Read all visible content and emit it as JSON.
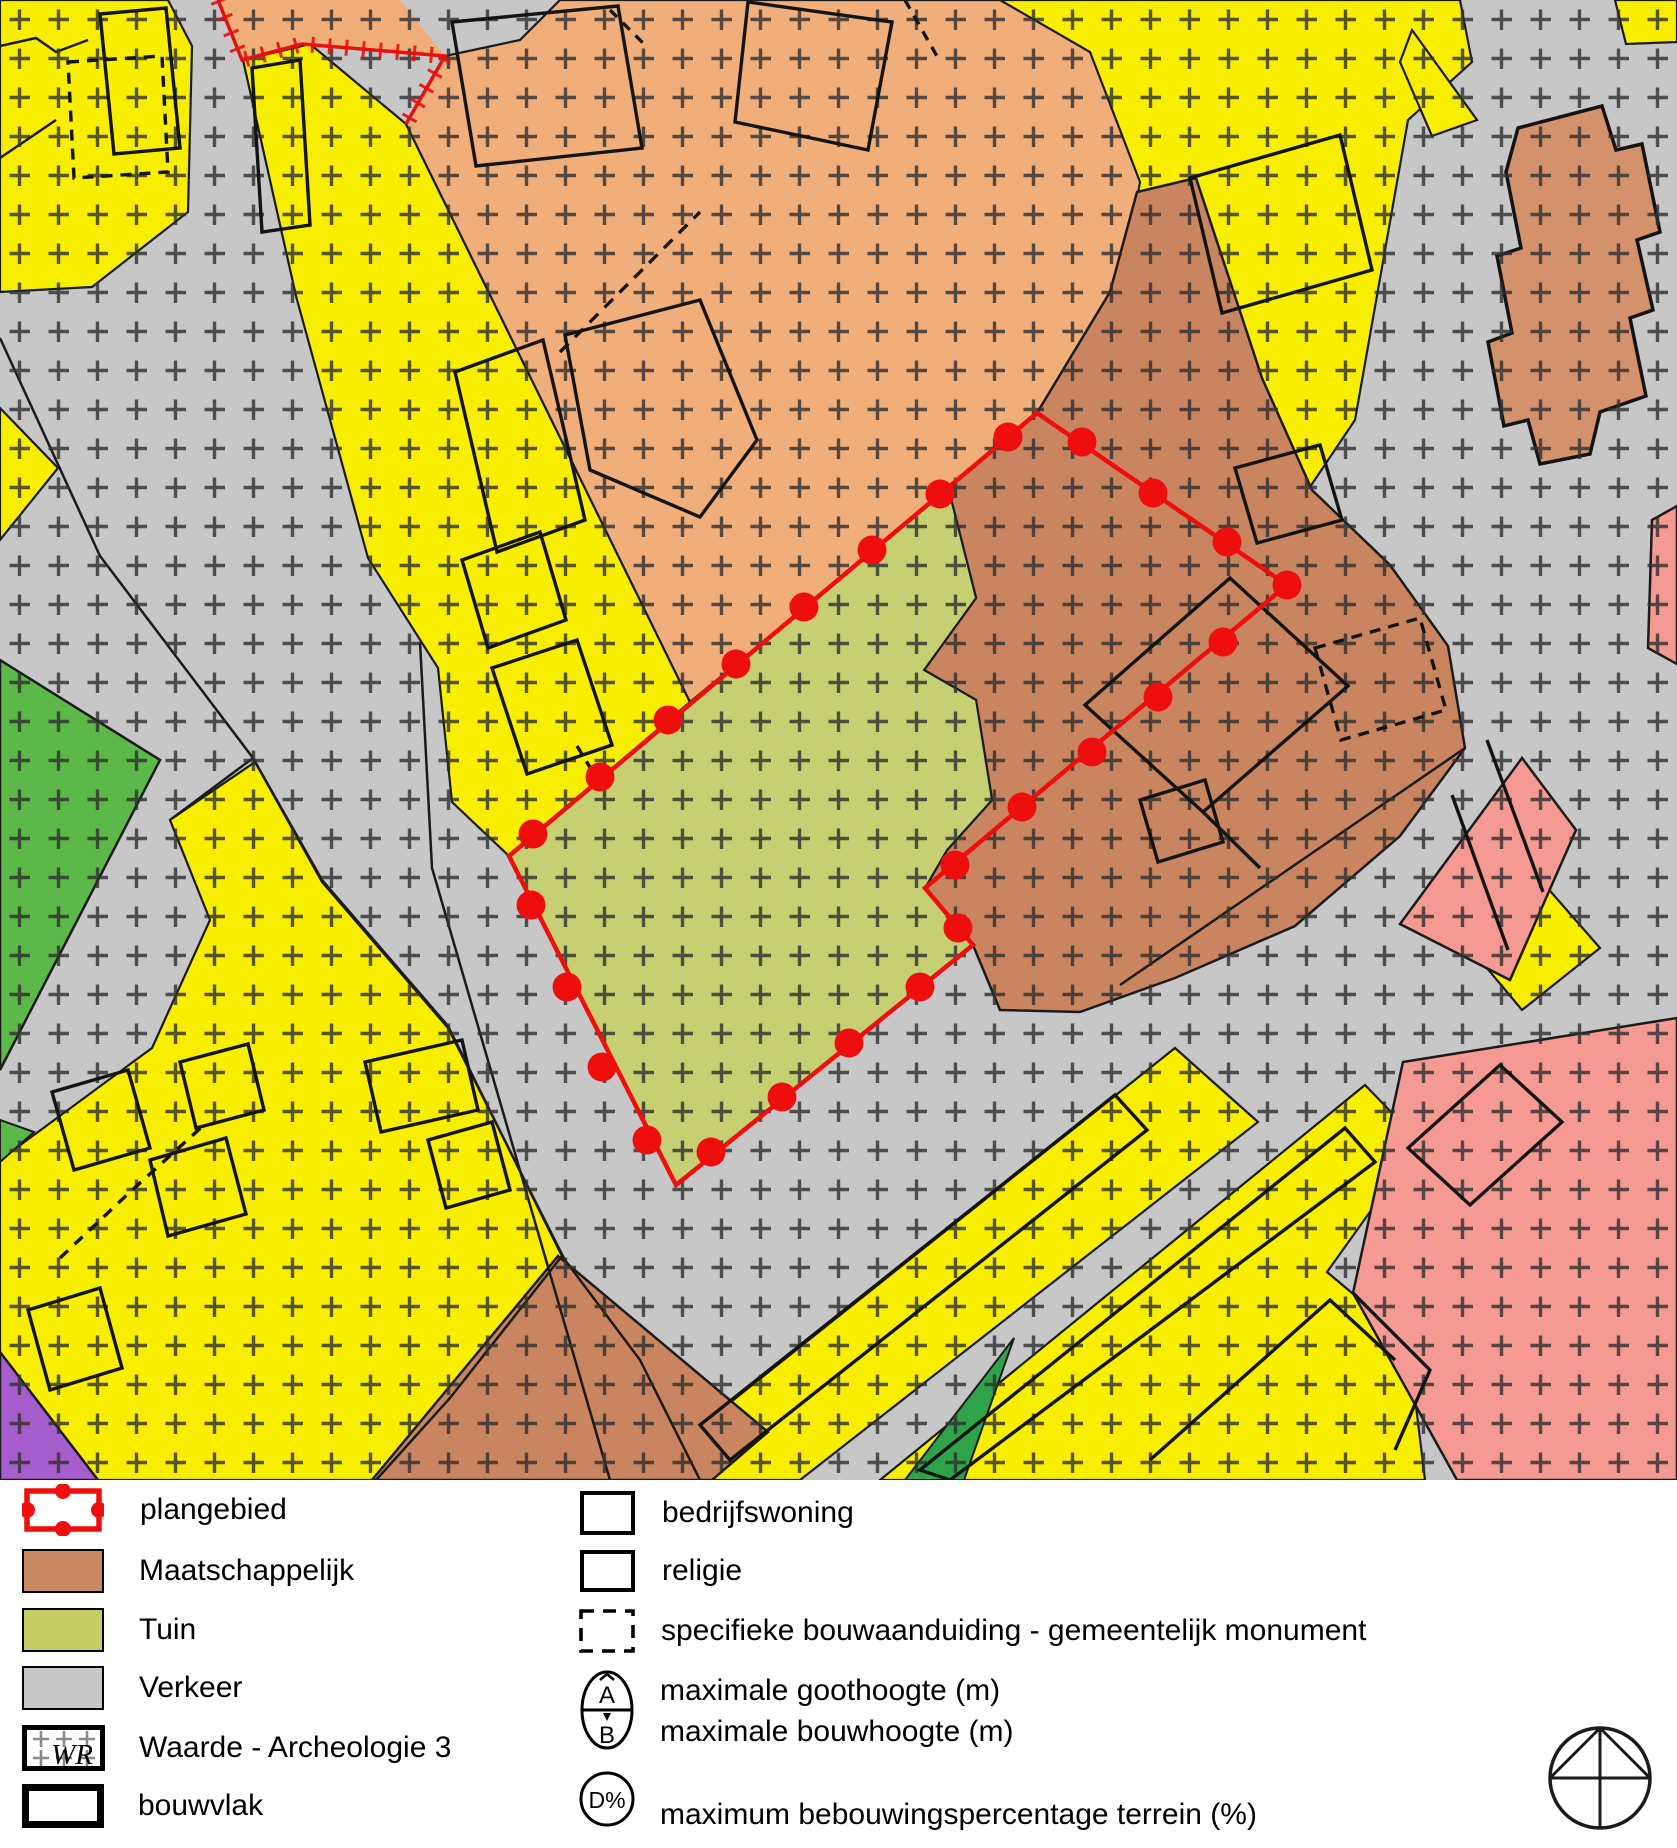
{
  "map": {
    "description_visible_text": "",
    "colors": {
      "plangebied_red": "#ee0e0e",
      "maatschappelijk": "#ca8a63",
      "maatschappelijk_light": "#f0ae7b",
      "tuin": "#c6d073",
      "verkeer_gray": "#c7c7c7",
      "wonen_yellow": "#f7ee00",
      "groen_dark": "#5db84a",
      "groen_sliver": "#2fa347",
      "purple": "#a55ecb",
      "pink": "#f59a92",
      "outline_black": "#1b1b1b"
    }
  },
  "legend": {
    "left": [
      {
        "label": "plangebied"
      },
      {
        "label": "Maatschappelijk",
        "color": "#ca8a63"
      },
      {
        "label": "Tuin",
        "color": "#c6d073"
      },
      {
        "label": "Verkeer",
        "color": "#c7c7c7"
      },
      {
        "label": "Waarde - Archeologie 3",
        "symbol_text": "WR"
      },
      {
        "label": "bouwvlak"
      }
    ],
    "right": [
      {
        "label": "bedrijfswoning"
      },
      {
        "label": "religie"
      },
      {
        "label": "specifieke bouwaanduiding - gemeentelijk monument"
      },
      {
        "label_top": "maximale goothoogte (m)",
        "label_bottom": "maximale bouwhoogte (m)",
        "letter_top": "A",
        "letter_bottom": "B"
      },
      {
        "label": "maximum bebouwingspercentage terrein (%)",
        "symbol_text": "D%"
      }
    ]
  }
}
